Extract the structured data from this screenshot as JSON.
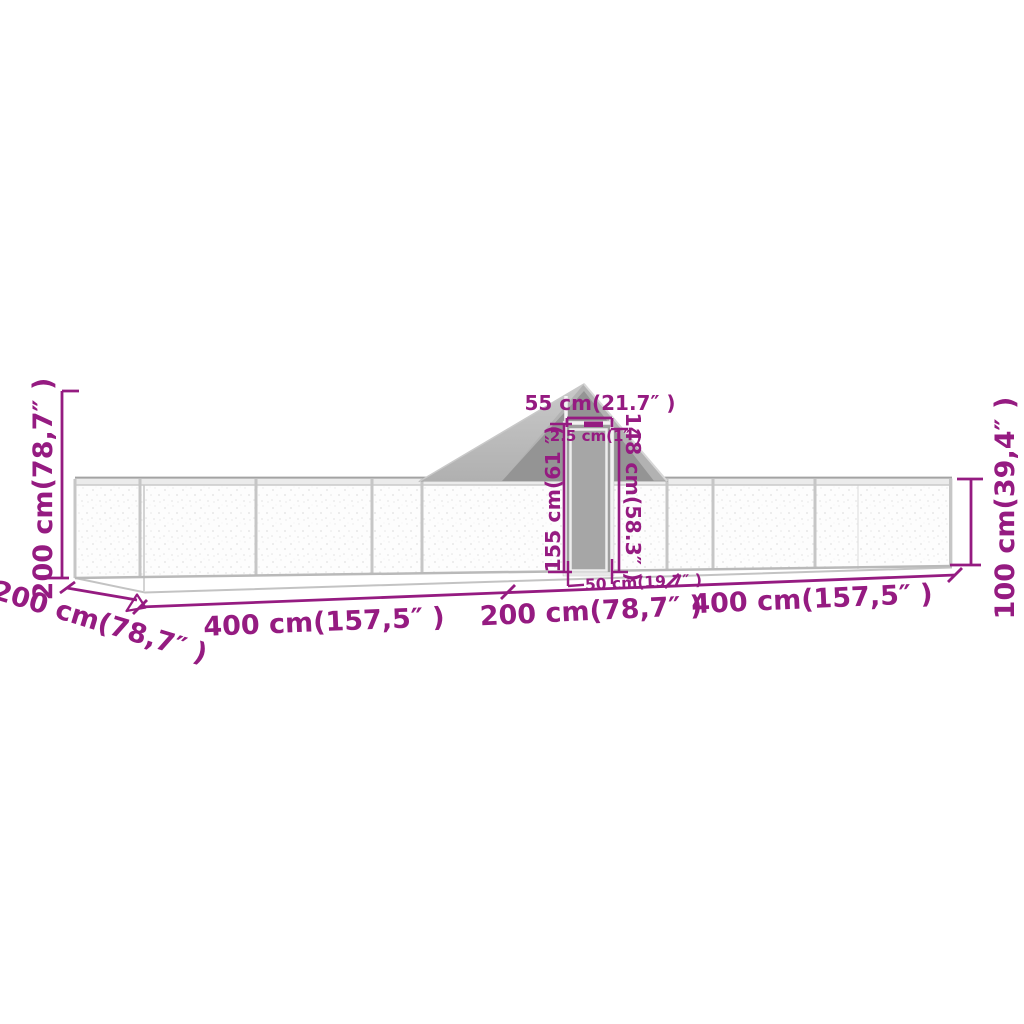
{
  "diagram": {
    "kind": "product-dimension-diagram",
    "subject": "chicken-coop-run-with-pitched-roof-and-door",
    "colors": {
      "dimension": "#951b81",
      "roof_light": "#c4c4c4",
      "roof_mid": "#b2b2b2",
      "roof_shadow": "#949494",
      "frame": "#c6c6c6",
      "panel": "#fdfdfd",
      "door_interior": "#9e9e9e",
      "background": "#ffffff"
    }
  },
  "dims": {
    "total_height": "200 cm(78,7″ )",
    "depth": "200 cm(78,7″ )",
    "run_left_length": "400 cm(157,5″ )",
    "center_length": "200 cm(78,7″ )",
    "run_right_length": "400 cm(157,5″ )",
    "door_bottom_width": "50 cm(19.7″ )",
    "wall_height": "100 cm(39,4″ )",
    "door_top_width": "55 cm(21.7″ )",
    "frame_tube": "2.5 cm(1″ )",
    "door_outer_height": "155 cm(61 ″)",
    "door_inner_height": "148 cm(58.3″ )"
  }
}
